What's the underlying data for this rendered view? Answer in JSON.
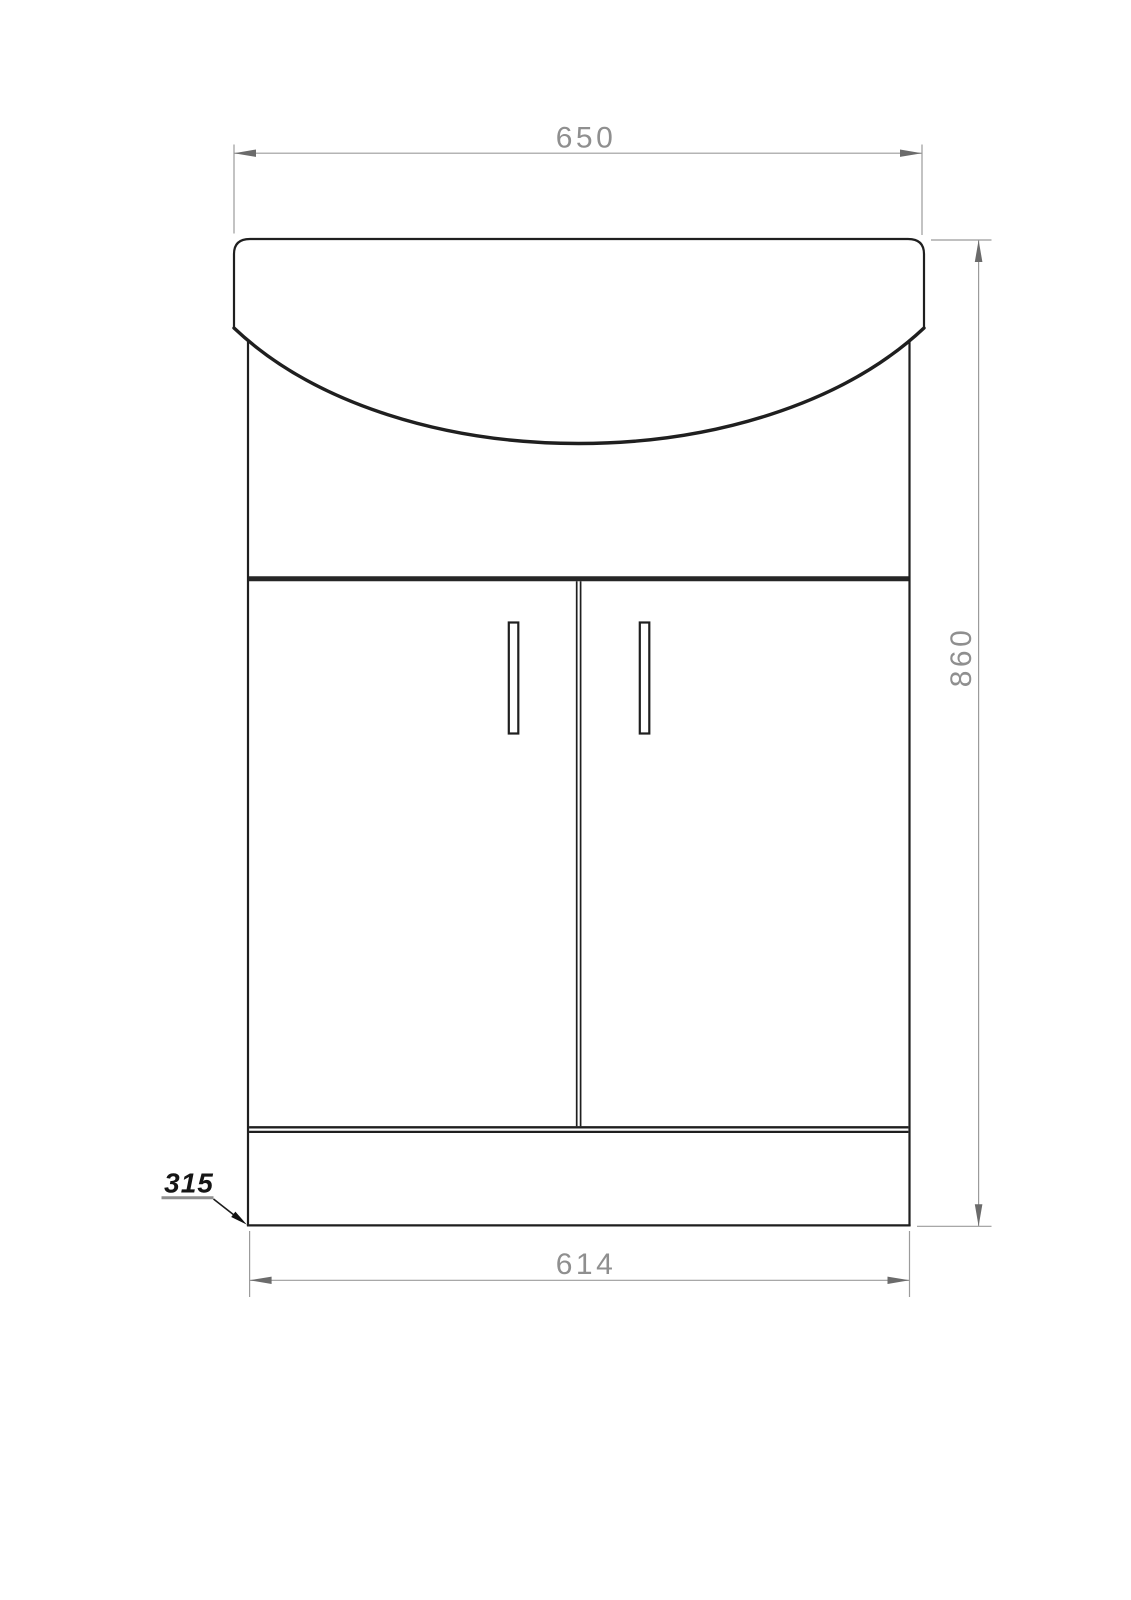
{
  "drawing": {
    "kind": "technical-drawing-vanity-unit-front-elevation",
    "background": "#ffffff"
  },
  "colors": {
    "outline": "#1f1f1f",
    "door_band": "#262626",
    "dimension_line": "#9b9b9b",
    "dimension_arrow": "#6b6b6b",
    "dimension_text": "#8f8f8f",
    "annotation_text": "#151515",
    "annotation_underline": "#8f8f8f"
  },
  "dimensions": {
    "top_width": "650",
    "overall_height": "860",
    "bottom_width": "614",
    "depth": "315"
  }
}
